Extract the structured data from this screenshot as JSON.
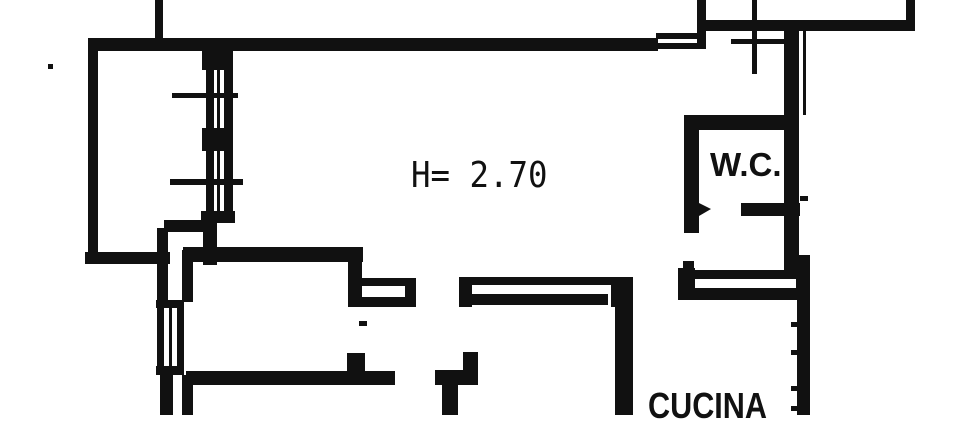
{
  "labels": {
    "ceiling_height": "H= 2.70",
    "wc": "W.C.",
    "kitchen": "CUCINA"
  },
  "colors": {
    "ink": "#111111",
    "paper": "#ffffff"
  }
}
